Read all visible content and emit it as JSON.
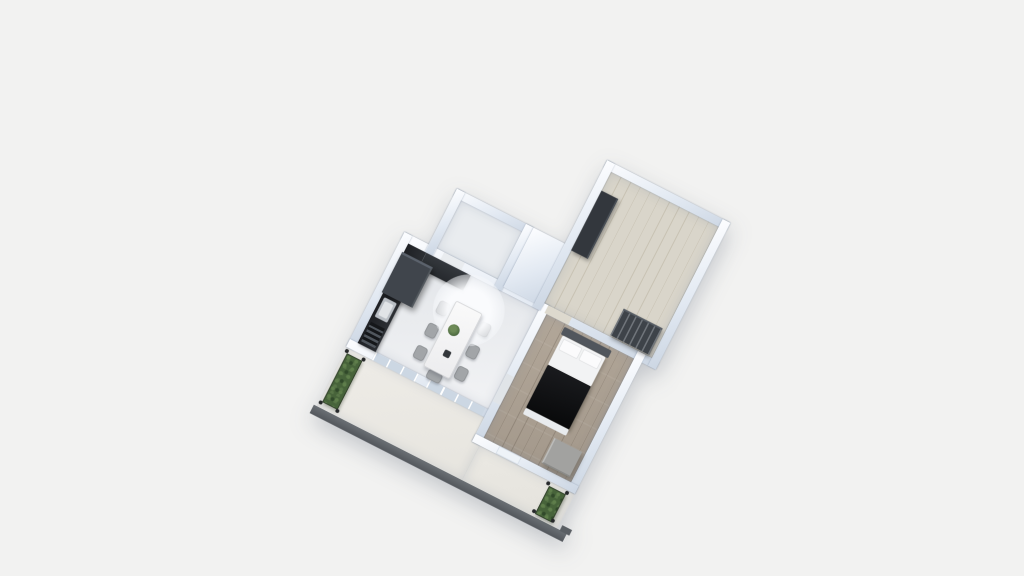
{
  "scene": {
    "type": "3d-floorplan-aerial-render",
    "background_color": "#f2f2f1",
    "plan_rotation_deg": 27,
    "visible_text": ""
  },
  "palette": {
    "background": "#f2f2f1",
    "wall_light": "#e8eef5",
    "wall_shadow": "#ccd6e3",
    "living_floor": "#e9ebee",
    "small_room_floor": "#e9ecef",
    "room_a_wood_floor": "#d9d5ca",
    "bedroom_wood_floor": "#a89d90",
    "balcony_floor": "#ebe9e3",
    "railing_gray": "#5a5f64",
    "kitchen_dark": "#26292d",
    "tall_cabinet": "#40454c",
    "dining_table_white": "#f6f6f6",
    "chair_gray": "#a2a5a8",
    "bed_blanket_black": "#0c0d0f",
    "bed_sheet_white": "#f2f3f4",
    "headboard_gray": "#51565d",
    "dresser_gray": "#a2a2a0",
    "wardrobe_dark": "#33373d",
    "hedge_green": "#47633a",
    "lamp_glow": "#f5f7fa",
    "plant_green": "#4e6b41"
  },
  "rooms": [
    {
      "id": "living-kitchen",
      "name": "living-room-with-kitchen",
      "floor_finish": "light gray",
      "contents": [
        "kitchen counter run",
        "tall cabinet (fridge column)",
        "sink",
        "wine rack",
        "dining table",
        "six side chairs",
        "one end chair",
        "round ceiling lamp",
        "table plant",
        "small bowl",
        "glazed balcony doors (2)"
      ]
    },
    {
      "id": "small-room",
      "name": "entry-room",
      "floor_finish": "light gray",
      "contents": [
        "open door leaf"
      ]
    },
    {
      "id": "room-a",
      "name": "second-bedroom",
      "floor_finish": "light wood planks",
      "contents": [
        "dark wardrobe",
        "dark shelf unit"
      ]
    },
    {
      "id": "bedroom",
      "name": "main-bedroom",
      "floor_finish": "gray-brown wood planks",
      "contents": [
        "double bed with black blanket and white pillows",
        "gray dresser",
        "window"
      ]
    },
    {
      "id": "balcony",
      "name": "balcony",
      "floor_finish": "off-white",
      "contents": [
        "dark gray railing wall",
        "hedge planter left",
        "hedge planter right",
        "corner posts (8)"
      ]
    }
  ]
}
